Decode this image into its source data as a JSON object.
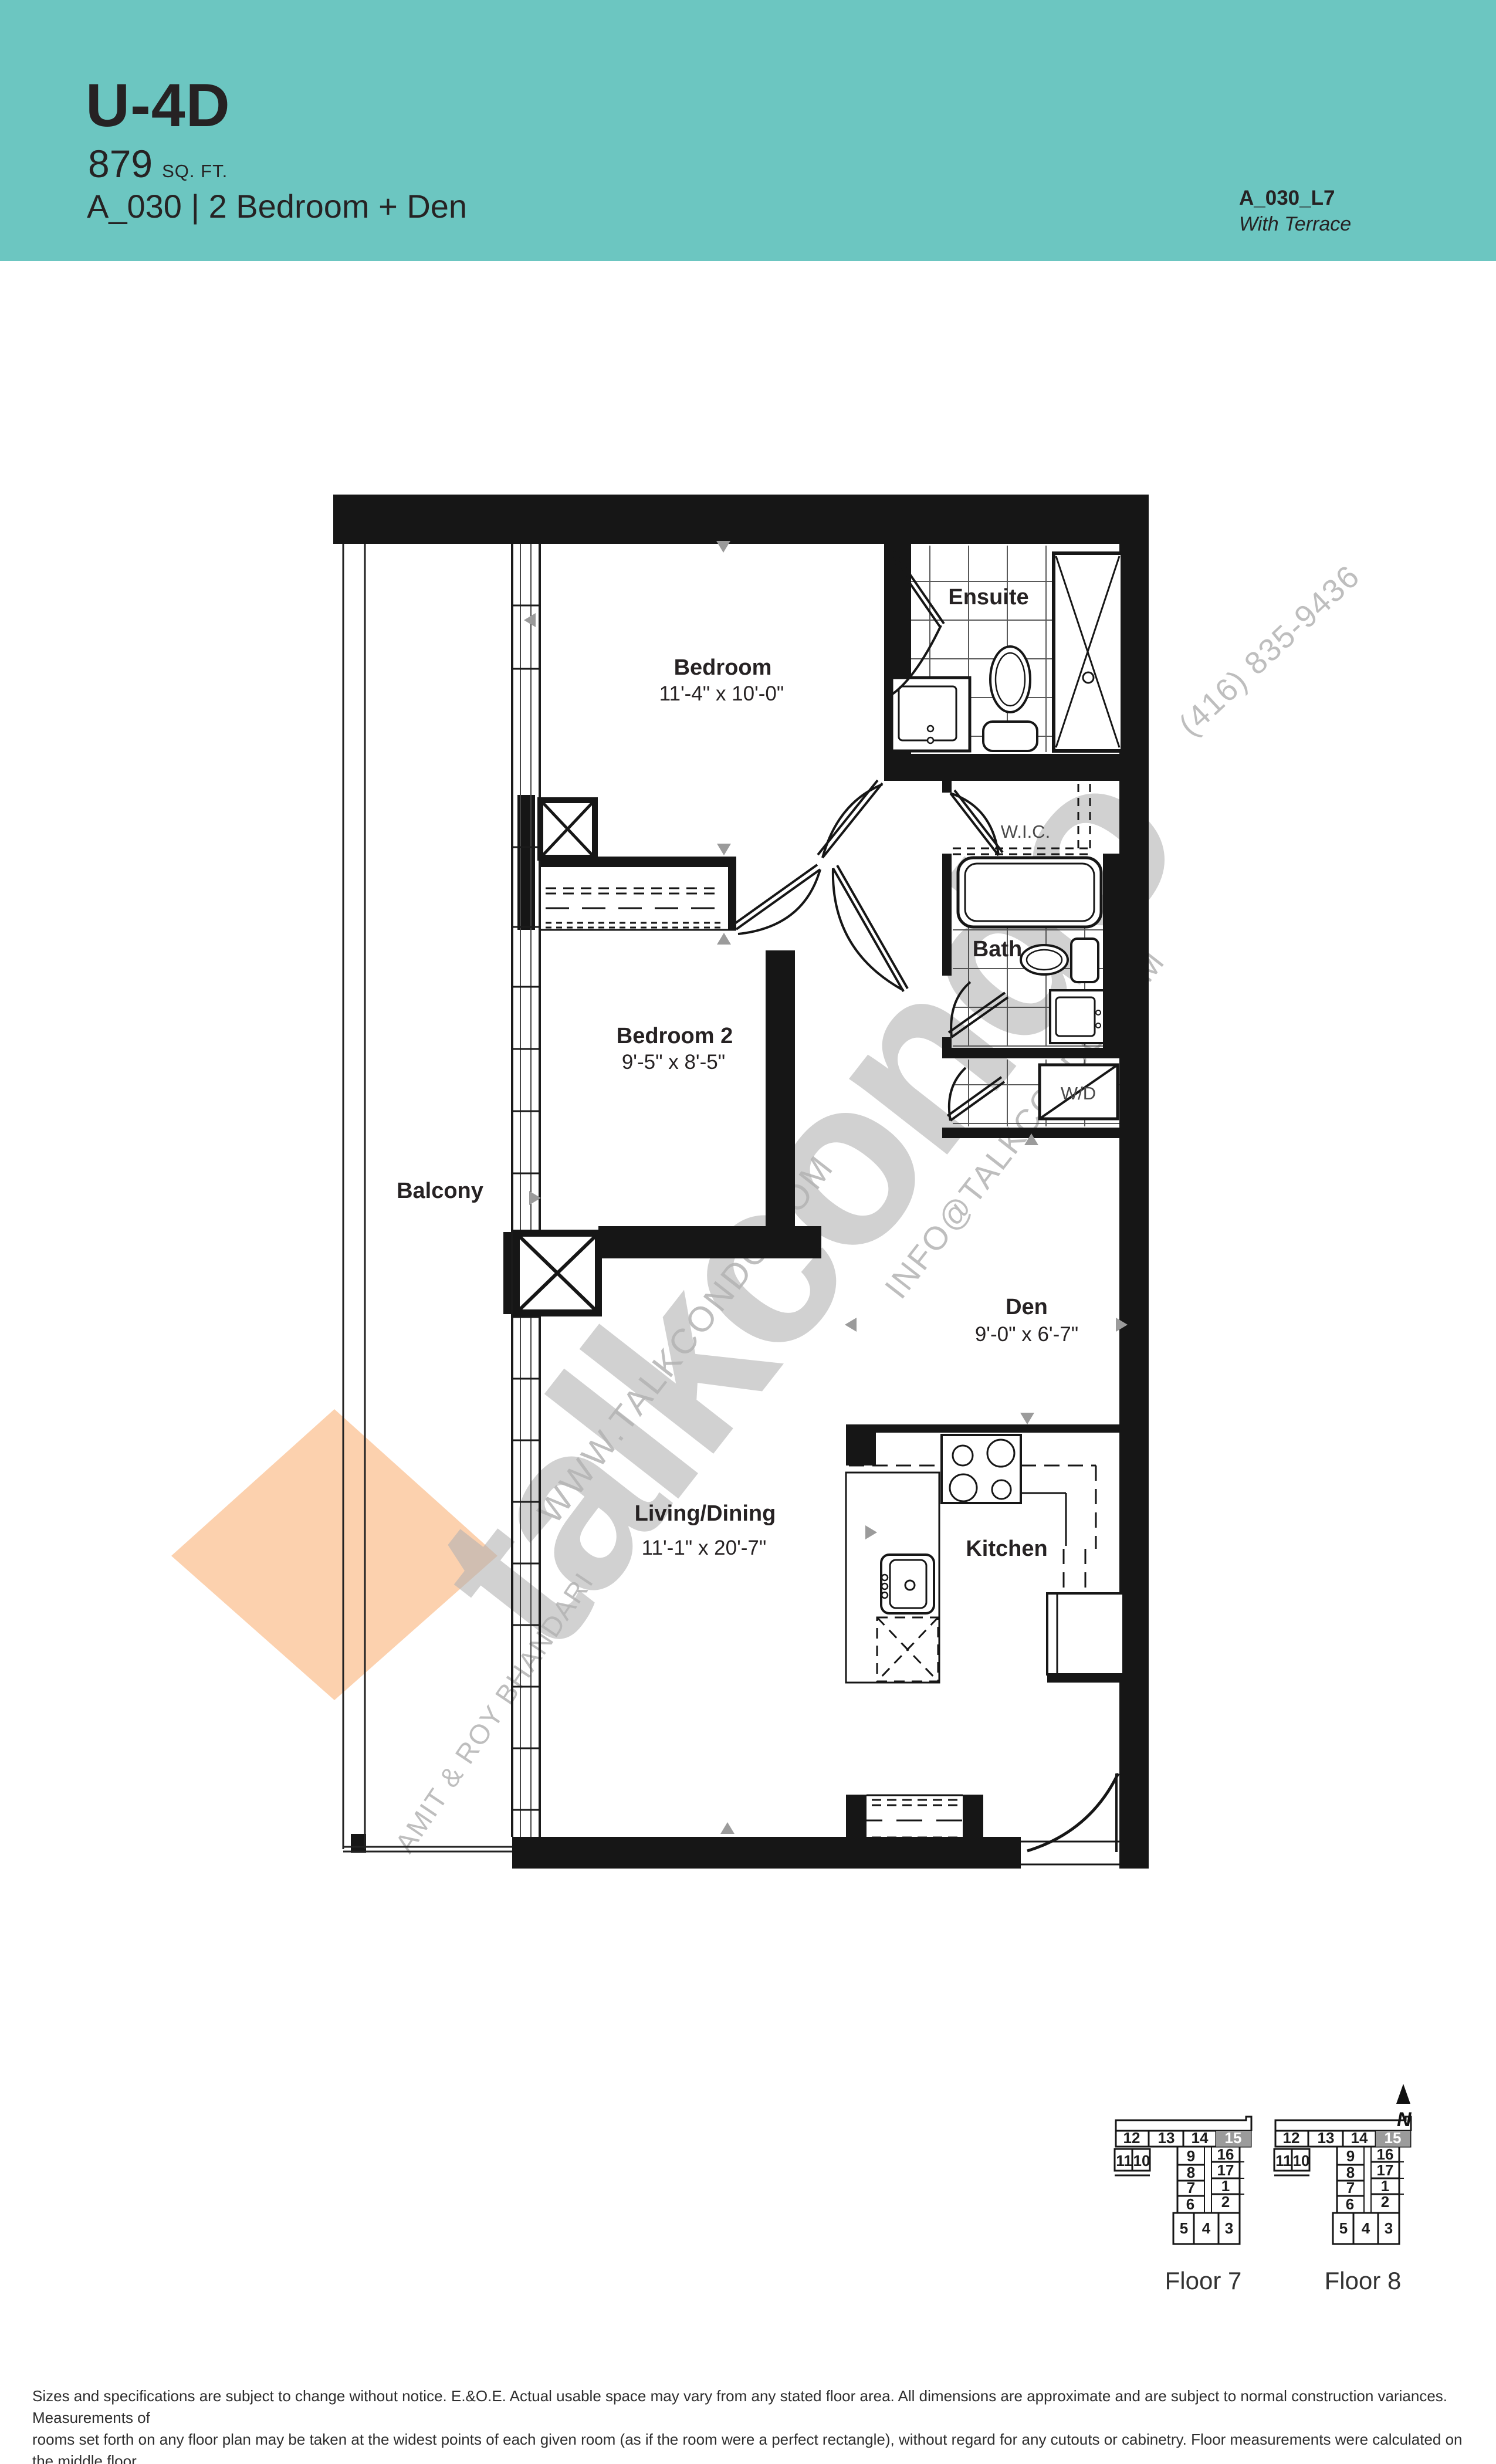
{
  "header": {
    "unit_code": "U-4D",
    "area_value": "879",
    "area_unit": "SQ. FT.",
    "subtitle": "A_030 | 2 Bedroom + Den",
    "plan_ref": "A_030_L7",
    "plan_note": "With Terrace"
  },
  "plan": {
    "rooms": {
      "bedroom": {
        "name": "Bedroom",
        "dims": "11'-4\" x 10'-0\""
      },
      "bedroom2": {
        "name": "Bedroom 2",
        "dims": "9'-5\" x 8'-5\""
      },
      "den": {
        "name": "Den",
        "dims": "9'-0\" x 6'-7\""
      },
      "living": {
        "name": "Living/Dining",
        "dims": "11'-1\" x 20'-7\""
      },
      "kitchen": {
        "name": "Kitchen"
      },
      "ensuite": {
        "name": "Ensuite"
      },
      "bath": {
        "name": "Bath"
      },
      "balcony": {
        "name": "Balcony"
      },
      "wic": {
        "name": "W.I.C."
      },
      "wd": {
        "name": "W/D"
      }
    }
  },
  "watermark": {
    "brand": "talkcondo",
    "website": "WWW.TALKCONDO.COM",
    "email": "INFO@TALKCONDO.COM",
    "phone": "(416) 835-9436",
    "agents": "AMIT & ROY BHANDARI"
  },
  "keys": {
    "north_label": "N",
    "floors": [
      {
        "label": "Floor 7"
      },
      {
        "label": "Floor 8"
      }
    ],
    "units": {
      "u1": "1",
      "u2": "2",
      "u3": "3",
      "u4": "4",
      "u5": "5",
      "u6": "6",
      "u7": "7",
      "u8": "8",
      "u9": "9",
      "u10": "10",
      "u11": "11",
      "u12": "12",
      "u13": "13",
      "u14": "14",
      "u15": "15",
      "u16": "16",
      "u17": "17"
    }
  },
  "disclaimer": {
    "lines": [
      "Sizes and specifications are subject to change without notice. E.&O.E. Actual usable space may vary from any stated floor area. All dimensions are approximate and are subject to normal construction variances. Measurements of",
      "rooms set forth on any floor plan may be taken at the widest points of each given room (as if the room were a perfect rectangle), without regard for any cutouts or cabinetry. Floor measurements were calculated on the middle floor",
      "of typical floor plates. Balcony and column locations may vary as per elevation feature. Balconies may be different on varying levels. Furniture and accessories are not included and are shown only as display."
    ]
  },
  "colors": {
    "teal": "#6cc6c1",
    "ink": "#262223",
    "wall_black": "#161616",
    "accent_orange": "#fcd1ae",
    "watermark_gray": "#b3b3b3",
    "key_highlight": "#9b9b9b"
  }
}
